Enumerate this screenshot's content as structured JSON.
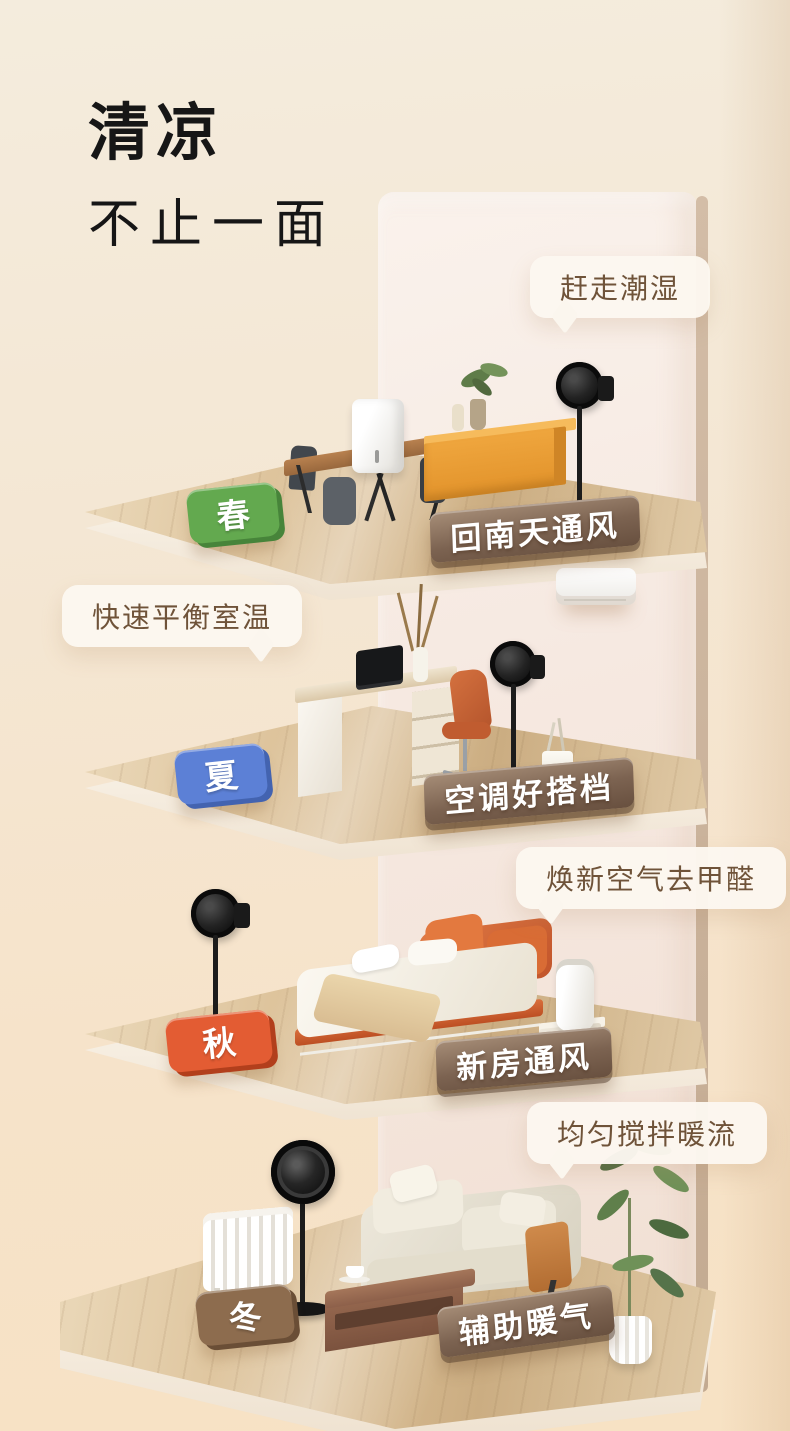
{
  "page": {
    "background_top": "#f4ebdc",
    "background_bottom": "#f7e2c4",
    "callout_text_color": "#6f5339"
  },
  "title": {
    "line1": "清凉",
    "line2": "不止一面"
  },
  "scenes": [
    {
      "id": "spring",
      "season": "春",
      "tag_color": "#63a94f",
      "tag_side_color": "#47843a",
      "callout": "赶走潮湿",
      "label": "回南天通风",
      "items": [
        "dehumidifier",
        "dining-table",
        "dining-chairs",
        "sideboard",
        "vase-and-plant",
        "pedestal-fan"
      ]
    },
    {
      "id": "summer",
      "season": "夏",
      "tag_color": "#5c80d6",
      "tag_side_color": "#4363b0",
      "callout": "快速平衡室温",
      "label": "空调好搭档",
      "items": [
        "air-conditioner",
        "desk",
        "laptop",
        "dried-grass-vase",
        "office-chair",
        "pedestal-fan",
        "cup-with-straws"
      ]
    },
    {
      "id": "autumn",
      "season": "秋",
      "tag_color": "#e35c33",
      "tag_side_color": "#b23f1c",
      "callout": "焕新空气去甲醛",
      "label": "新房通风",
      "items": [
        "pedestal-fan",
        "double-bed",
        "throw-blanket",
        "nightstand",
        "air-purifier"
      ]
    },
    {
      "id": "winter",
      "season": "冬",
      "tag_color": "#8d6c4e",
      "tag_side_color": "#6a4e36",
      "callout": "均匀搅拌暖流",
      "label": "辅助暖气",
      "items": [
        "radiator-heater",
        "circulator-fan",
        "coffee-table",
        "coffee-cup",
        "sofa",
        "throw-blanket",
        "potted-plant"
      ]
    }
  ]
}
